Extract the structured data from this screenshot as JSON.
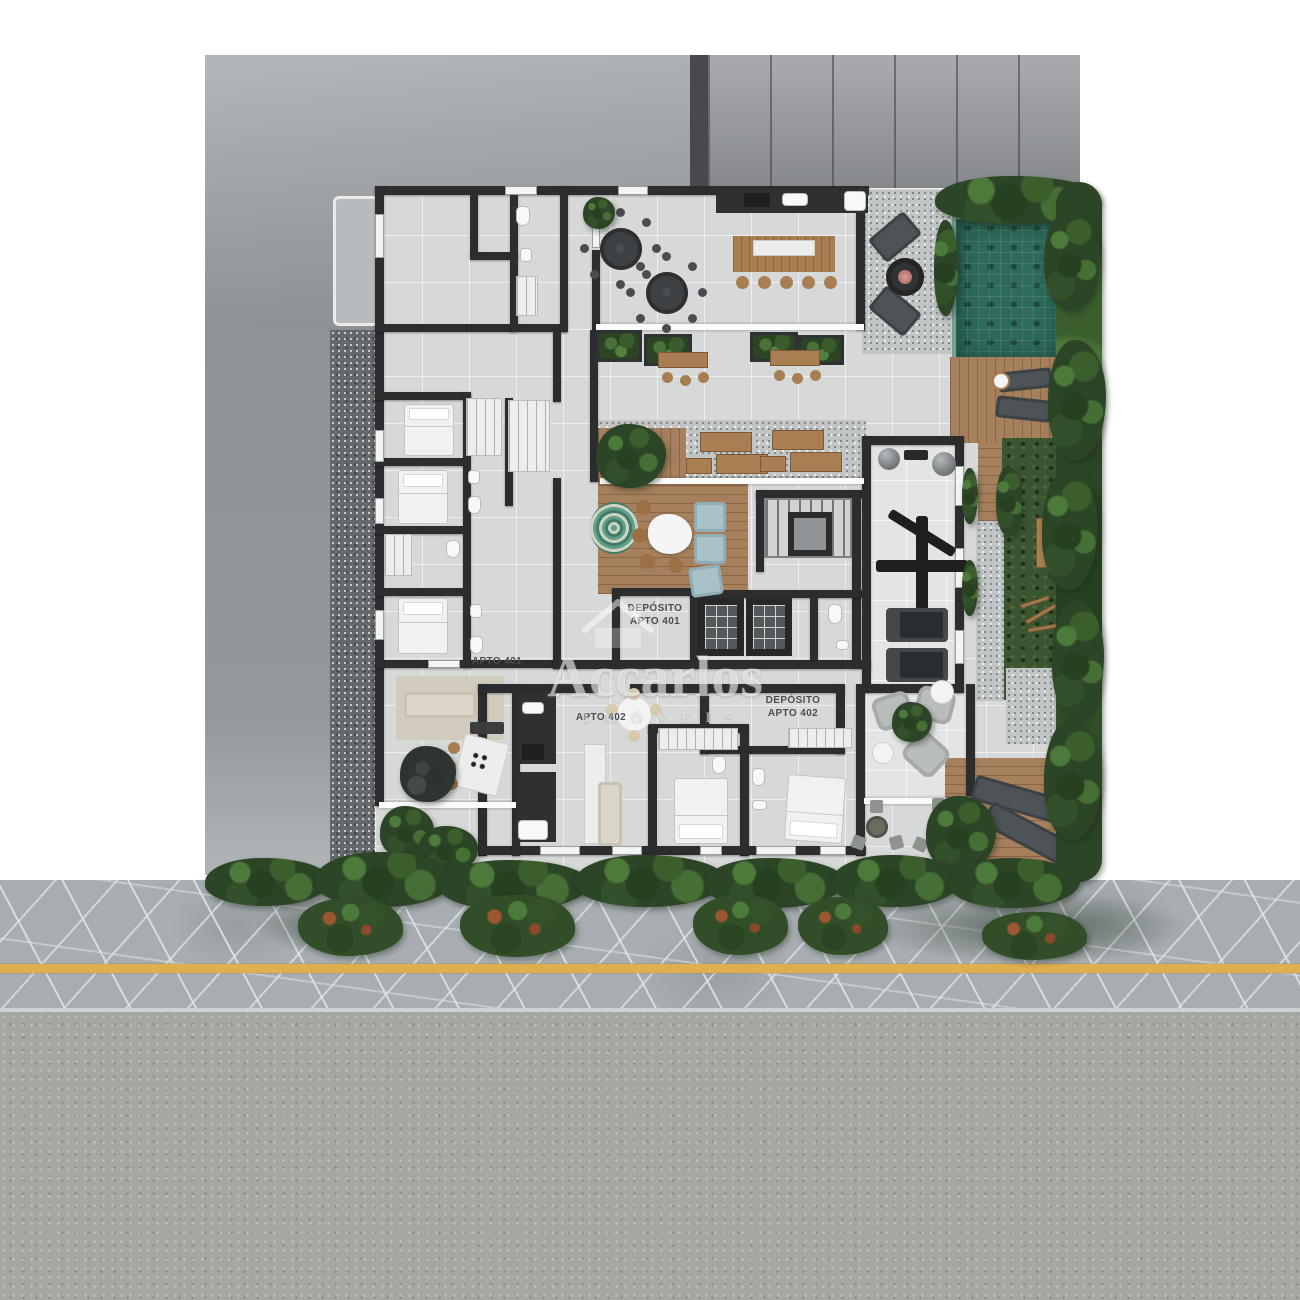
{
  "labels": {
    "deposito_401_line1": "DEPÓSITO",
    "deposito_401_line2": "APTO 401",
    "apto_401": "APTO 401",
    "apto_402": "APTO 402",
    "deposito_402_line1": "DEPÓSITO",
    "deposito_402_line2": "APTO 402"
  },
  "watermark": {
    "brand": "Accarlos",
    "subtitle": "IMÓVEIS",
    "icon": "house-icon"
  },
  "palette": {
    "background": "#ffffff",
    "roof_light": "#a6abae",
    "roof_panels": "#999c9f",
    "wall": "#2b2d2f",
    "floor_tile": "#d7d9d8",
    "deck_wood": "#a6805c",
    "gravel": "#c2c5c5",
    "grass": "#3c5531",
    "hedge": "#2c4526",
    "pool_water": "#2e6b5c",
    "sidewalk": "#a7adb0",
    "street": "#a4a8a1",
    "road_line": "#dfae4d",
    "label_text": "#4b4e50",
    "watermark": "rgba(255,255,255,0.55)"
  }
}
